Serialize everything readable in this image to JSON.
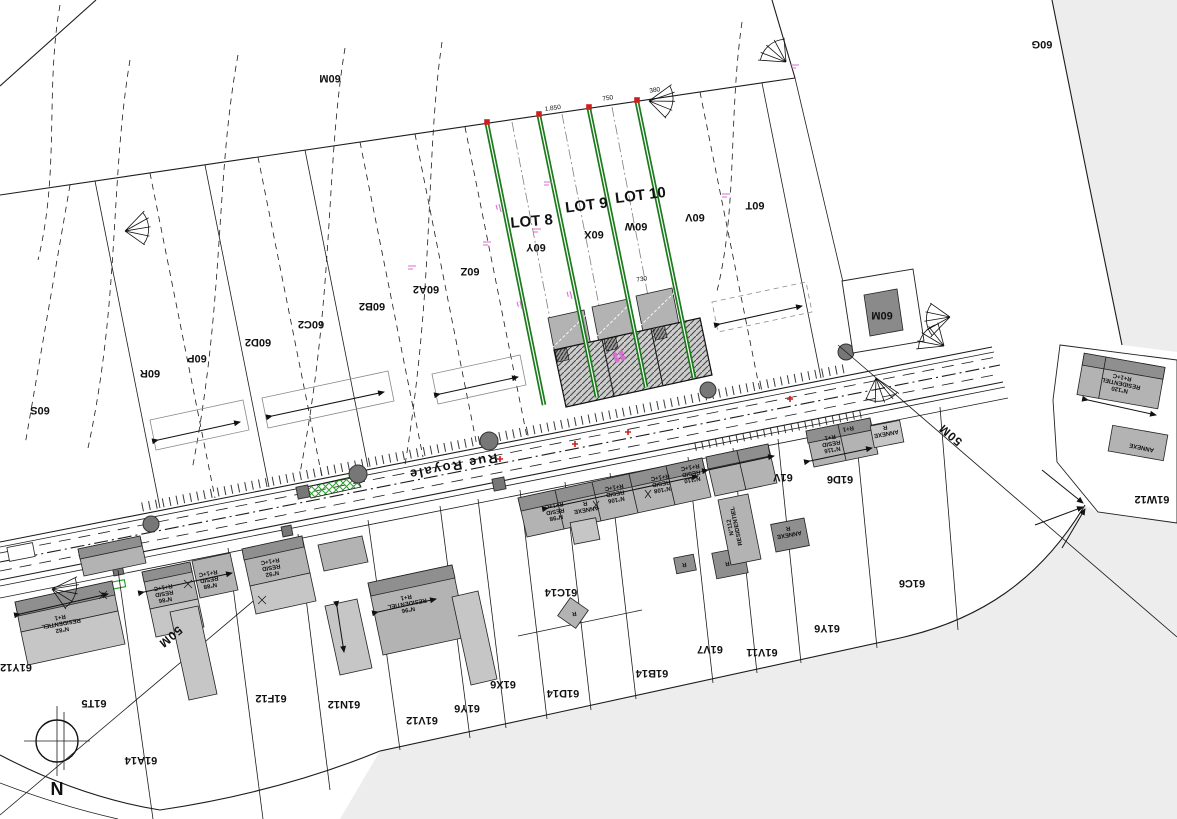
{
  "colors": {
    "background": "#ffffff",
    "line": "#1c1c1c",
    "road_gray": "#ededed",
    "building_gray": "#b3b3b3",
    "building_dark": "#8f8f8f",
    "new_lot_green": "#1b7a1b",
    "island_green": "#2e9e2e",
    "survey_red": "#cc2020",
    "elevation_magenta": "#d66fd0"
  },
  "north": {
    "label": "N"
  },
  "street": {
    "name": "Rue Royale"
  },
  "lot_labels": [
    {
      "text": "LOT 8"
    },
    {
      "text": "LOT 9"
    },
    {
      "text": "LOT 10"
    }
  ],
  "distance_labels": [
    {
      "text": "50M"
    },
    {
      "text": "50M"
    }
  ],
  "parcel_labels": [
    {
      "text": "60M",
      "x": 330,
      "y": 75,
      "rot": 180
    },
    {
      "text": "60G",
      "x": 1042,
      "y": 41,
      "rot": 180
    },
    {
      "text": "60S",
      "x": 40,
      "y": 407,
      "rot": 180
    },
    {
      "text": "60R",
      "x": 150,
      "y": 370,
      "rot": 180
    },
    {
      "text": "60P",
      "x": 197,
      "y": 355,
      "rot": 180
    },
    {
      "text": "60D2",
      "x": 258,
      "y": 339,
      "rot": 180
    },
    {
      "text": "60C2",
      "x": 311,
      "y": 321,
      "rot": 180
    },
    {
      "text": "60B2",
      "x": 372,
      "y": 303,
      "rot": 180
    },
    {
      "text": "60A2",
      "x": 426,
      "y": 286,
      "rot": 180
    },
    {
      "text": "60Z",
      "x": 470,
      "y": 268,
      "rot": 180
    },
    {
      "text": "60Y",
      "x": 536,
      "y": 244,
      "rot": 180
    },
    {
      "text": "60X",
      "x": 594,
      "y": 231,
      "rot": 180
    },
    {
      "text": "60W",
      "x": 636,
      "y": 223,
      "rot": 180
    },
    {
      "text": "60V",
      "x": 695,
      "y": 214,
      "rot": 180
    },
    {
      "text": "60T",
      "x": 755,
      "y": 202,
      "rot": 180
    },
    {
      "text": "60M",
      "x": 882,
      "y": 312,
      "rot": 180
    },
    {
      "text": "61Y12",
      "x": 16,
      "y": 664,
      "rot": 180
    },
    {
      "text": "61T5",
      "x": 94,
      "y": 700,
      "rot": 180
    },
    {
      "text": "61A14",
      "x": 141,
      "y": 757,
      "rot": 180
    },
    {
      "text": "61F12",
      "x": 271,
      "y": 695,
      "rot": 180
    },
    {
      "text": "61N12",
      "x": 344,
      "y": 701,
      "rot": 180
    },
    {
      "text": "61V12",
      "x": 422,
      "y": 717,
      "rot": 180
    },
    {
      "text": "61Y6",
      "x": 467,
      "y": 705,
      "rot": 180
    },
    {
      "text": "61X6",
      "x": 503,
      "y": 681,
      "rot": 180
    },
    {
      "text": "61D14",
      "x": 563,
      "y": 690,
      "rot": 180
    },
    {
      "text": "61C14",
      "x": 561,
      "y": 589,
      "rot": 180
    },
    {
      "text": "61B14",
      "x": 652,
      "y": 670,
      "rot": 180
    },
    {
      "text": "61V7",
      "x": 710,
      "y": 646,
      "rot": 180
    },
    {
      "text": "61V11",
      "x": 762,
      "y": 649,
      "rot": 180
    },
    {
      "text": "61Y6",
      "x": 827,
      "y": 625,
      "rot": 180
    },
    {
      "text": "61V",
      "x": 783,
      "y": 474,
      "rot": 180
    },
    {
      "text": "61D6",
      "x": 840,
      "y": 476,
      "rot": 180
    },
    {
      "text": "61C6",
      "x": 912,
      "y": 580,
      "rot": 180
    },
    {
      "text": "61W12",
      "x": 1152,
      "y": 496,
      "rot": 180
    }
  ],
  "building_labels": [
    {
      "text": "N°82\nRESIDENTIEL\nR+1",
      "x": 62,
      "y": 628,
      "rot": 170
    },
    {
      "text": "N°86\nRESID\nR+1+C",
      "x": 165,
      "y": 598,
      "rot": 170
    },
    {
      "text": "N°88\nRESID\nR+1+C",
      "x": 210,
      "y": 584,
      "rot": 170
    },
    {
      "text": "N°92\nRESID\nR+1+C",
      "x": 272,
      "y": 572,
      "rot": 170
    },
    {
      "text": "N°96\nRESIDENTIEL\nR+1",
      "x": 408,
      "y": 608,
      "rot": 170
    },
    {
      "text": "N°98\nRESID\nR+1+C",
      "x": 556,
      "y": 516,
      "rot": 170
    },
    {
      "text": "ANNEXE\nR",
      "x": 586,
      "y": 508,
      "rot": 170
    },
    {
      "text": "N°106\nRESID\nR+1+C",
      "x": 616,
      "y": 498,
      "rot": 170
    },
    {
      "text": "N°108\nRESID\nR+1+C",
      "x": 662,
      "y": 488,
      "rot": 170
    },
    {
      "text": "N°110\nRESID\nR+1+C",
      "x": 692,
      "y": 478,
      "rot": 170
    },
    {
      "text": "N°112\nRESIDENTIEL",
      "x": 732,
      "y": 527,
      "rot": 258
    },
    {
      "text": "N°116\nRESID\nR+1",
      "x": 832,
      "y": 448,
      "rot": 170
    },
    {
      "text": "R+1",
      "x": 848,
      "y": 427,
      "rot": 170
    },
    {
      "text": "N°120\nRESIDENTIEL\nR+1+C",
      "x": 1120,
      "y": 388,
      "rot": 192
    },
    {
      "text": "ANNEXE",
      "x": 1142,
      "y": 446,
      "rot": 192
    },
    {
      "text": "ANNEXE\nR",
      "x": 886,
      "y": 432,
      "rot": 170
    },
    {
      "text": "ANNEXE\nR",
      "x": 789,
      "y": 533,
      "rot": 170
    },
    {
      "text": "R",
      "x": 727,
      "y": 562,
      "rot": 170
    },
    {
      "text": "R",
      "x": 684,
      "y": 563,
      "rot": 170
    },
    {
      "text": "R",
      "x": 574,
      "y": 612,
      "rot": 170
    }
  ],
  "dimension_labels": [
    {
      "text": "1.850",
      "x": 553,
      "y": 110,
      "rot": -8
    },
    {
      "text": "750",
      "x": 608,
      "y": 100,
      "rot": -8
    },
    {
      "text": "380",
      "x": 655,
      "y": 92,
      "rot": -8
    },
    {
      "text": "730",
      "x": 642,
      "y": 281,
      "rot": -8
    }
  ]
}
